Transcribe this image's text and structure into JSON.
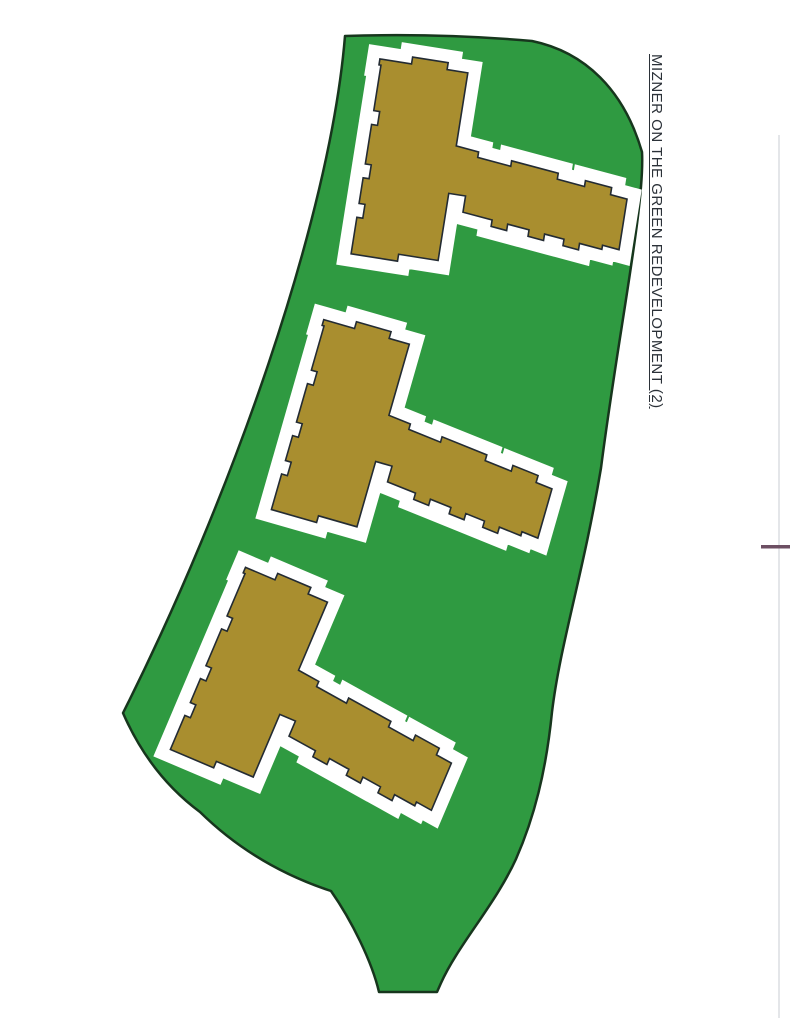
{
  "title": {
    "text": "MIZNER ON THE GREEN REDEVELOPMENT (2)"
  },
  "site": {
    "building_count": 3
  },
  "colors": {
    "page_background": "#ffffff",
    "parcel_green": "#2f9a41",
    "parcel_outline_dark": "#17361d",
    "building_gold": "#a98e2f",
    "building_outline_dark": "#232b33",
    "setback_white": "#ffffff",
    "title_text": "#2b3138",
    "scan_line_gray": "#d3d6da",
    "scan_mark_maroon": "#6d4f63"
  }
}
